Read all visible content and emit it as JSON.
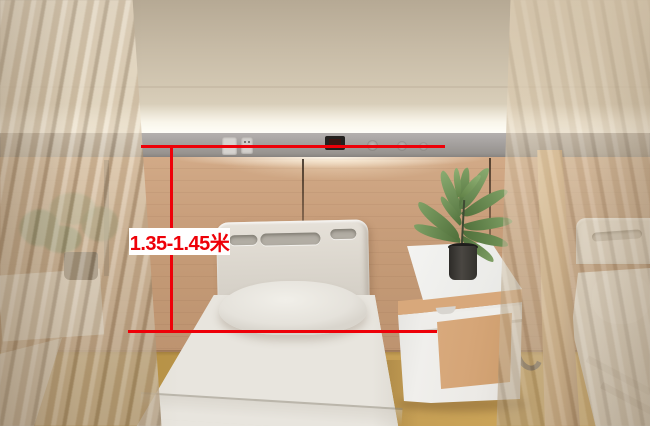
{
  "annotation": {
    "dimension_label": "1.35-1.45米",
    "line_color": "#ee0008",
    "label_background": "#ffffff"
  },
  "scene": {
    "objects": [
      "hospital-bed",
      "bed-headboard",
      "pillow",
      "mattress",
      "bedside-cabinet",
      "potted-plant",
      "headwall-rail",
      "power-socket-panel",
      "bedside-control-display",
      "gas-outlet",
      "wall-light-strip",
      "privacy-curtain-left",
      "privacy-curtain-right",
      "neighbor-bed",
      "wood-post",
      "grab-handle",
      "wood-wall",
      "floor"
    ],
    "palette": {
      "upper_wall": "#cdc1ac",
      "headwall_band": "#a6a2a0",
      "wood_wall": "#c99f7c",
      "floor": "#c09a50",
      "bed_linen": "#e8e5de",
      "cabinet_wood": "#d5a577",
      "plant_green": "#7fa065"
    }
  }
}
